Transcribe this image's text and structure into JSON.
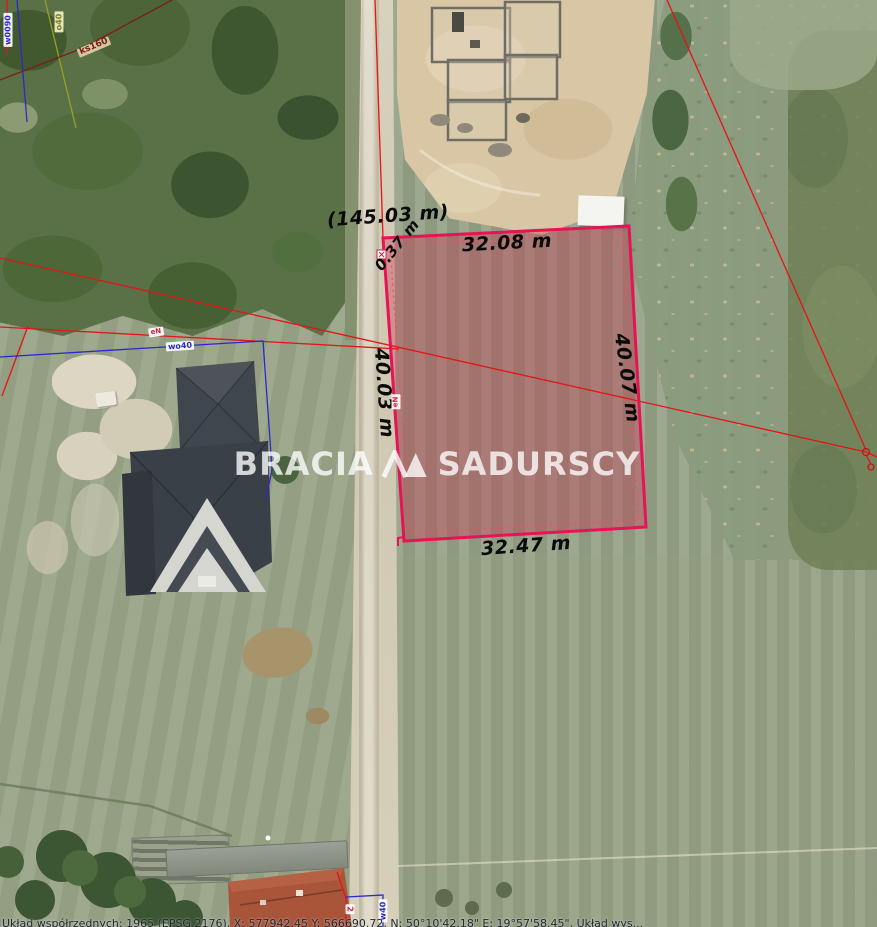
{
  "map": {
    "watermark": {
      "word_left": "BRACIA",
      "word_right": "SADURSCY"
    },
    "measurements": {
      "road_frontage_total": "(145.03 m)",
      "corner_segment": "0.37 m",
      "edge_top": "32.08 m",
      "edge_right": "40.07 m",
      "edge_bottom": "32.47 m",
      "edge_left": "40.03 m"
    },
    "utility_labels": {
      "top_left_blue": "w0090",
      "top_left_yellow": "o40",
      "top_left_brown": "ks160",
      "water_line": "wo40",
      "power_left": "eN",
      "power_parcel": "eN",
      "bottom_red": "2",
      "bottom_blue": "w40"
    },
    "footer_coords": "Układ współrzędnych: 1965 (EPSG 2176), X: 577942.45 Y: 566690.72, N: 50°10'42.18\" E: 19°57'58.45\", Układ wys...",
    "colors": {
      "parcel_outline": "#e81254",
      "parcel_fill": "rgba(201,38,73,0.34)",
      "survey_line_red": "#e31515",
      "utility_blue": "#2a2acc",
      "utility_yellow": "#9aa023",
      "utility_brown": "#7a2015",
      "watermark_white": "rgba(255,255,255,0.78)"
    }
  }
}
